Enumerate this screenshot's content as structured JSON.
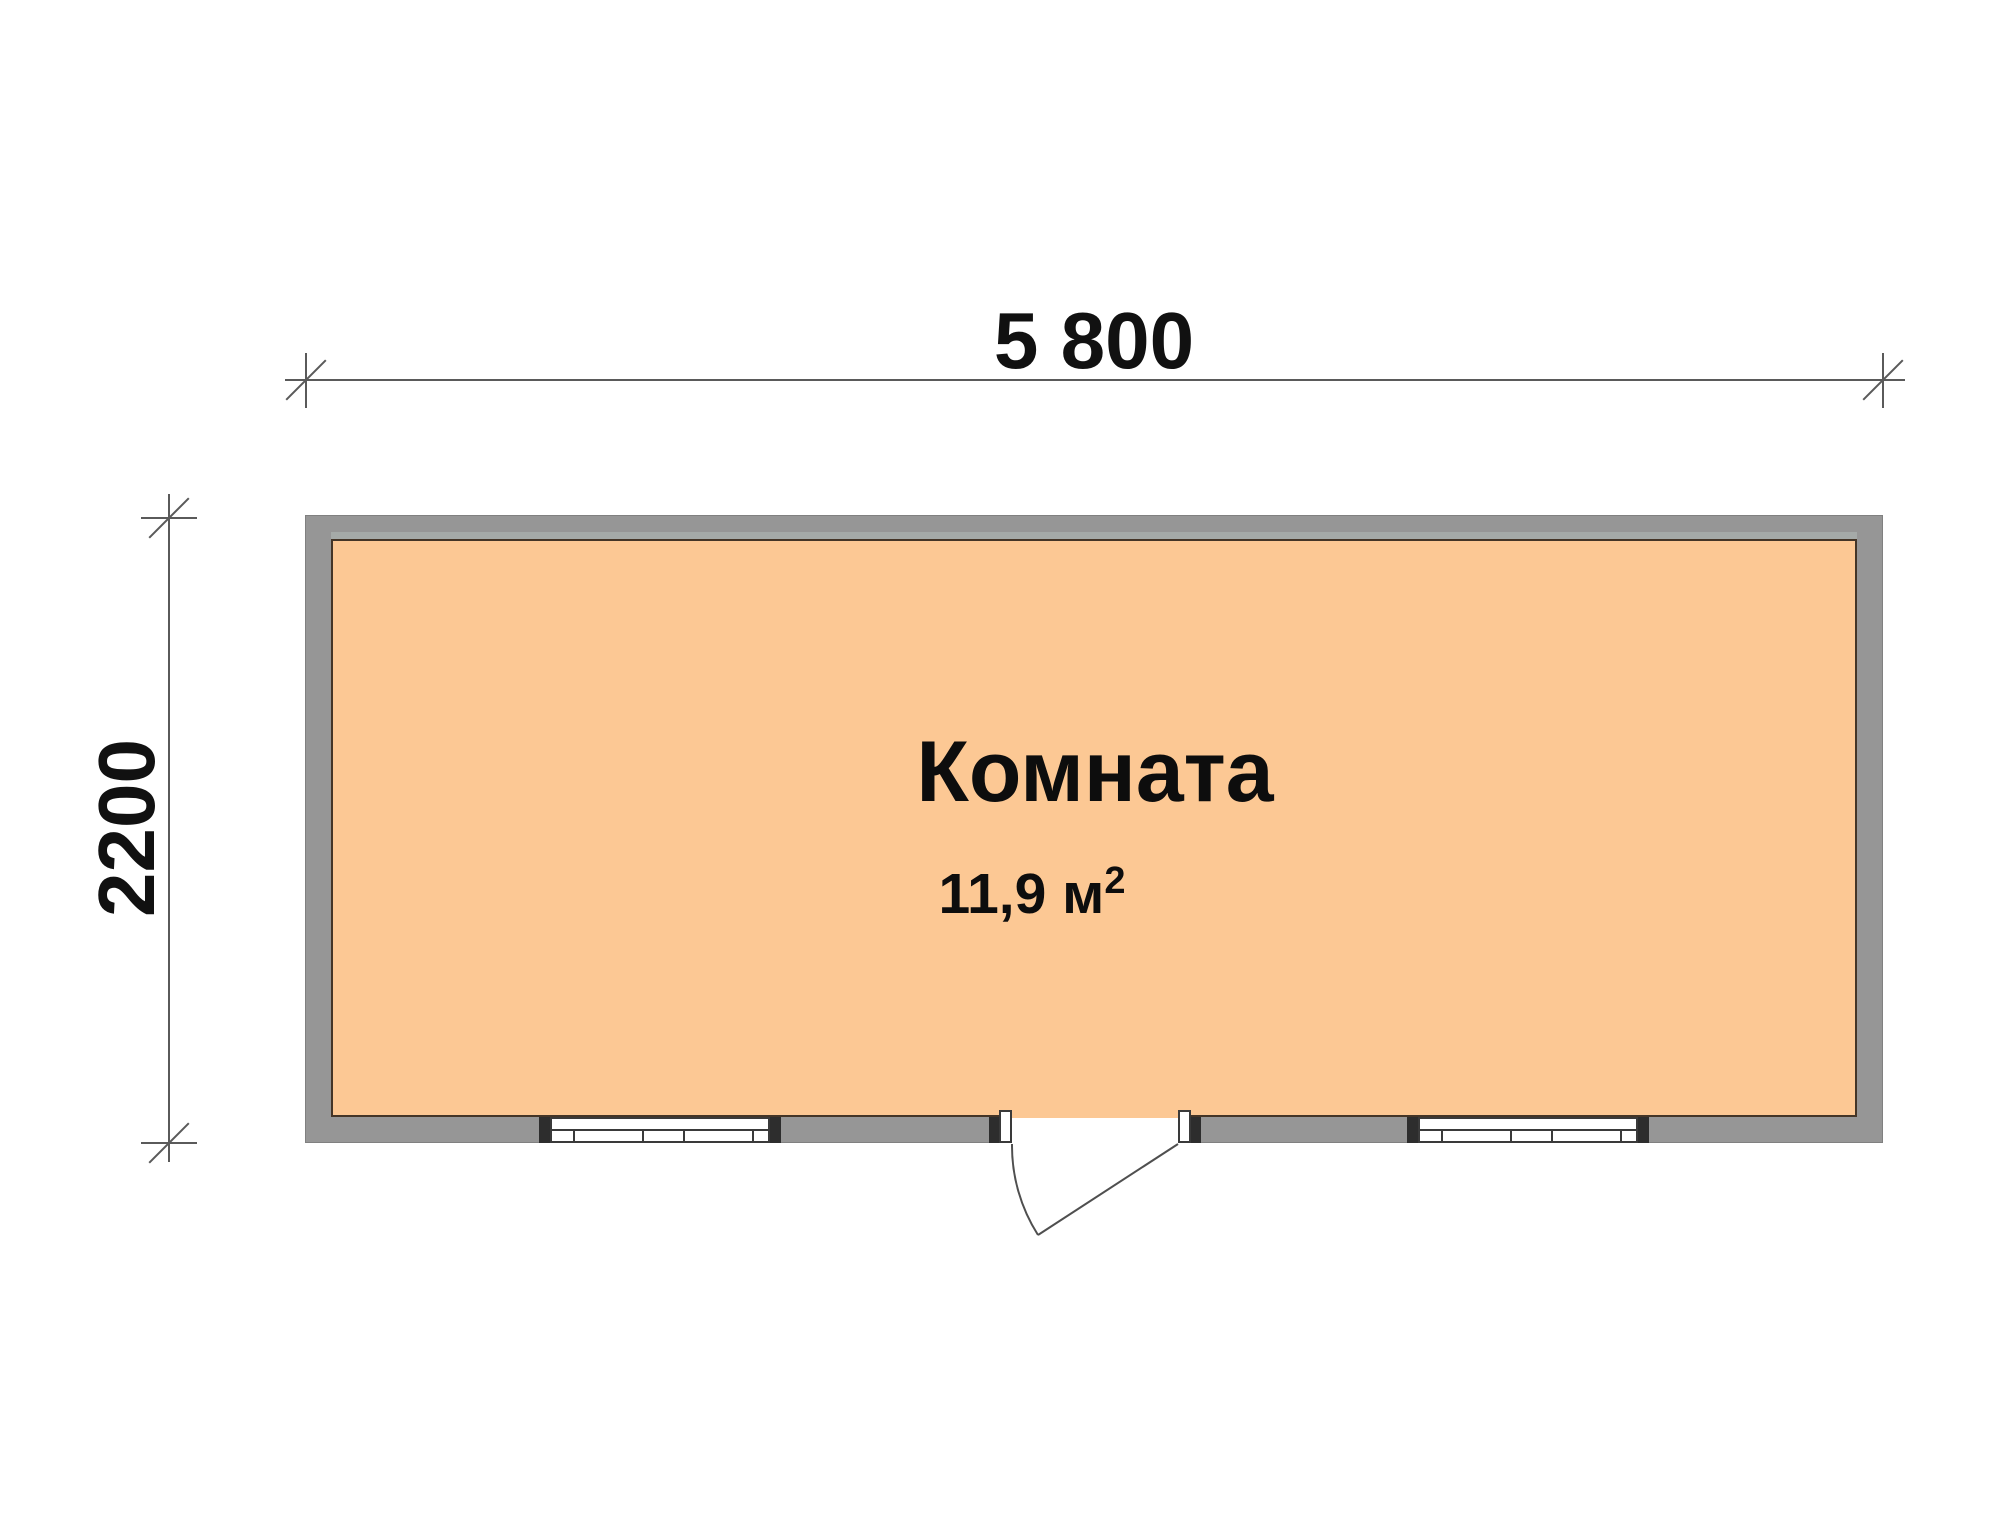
{
  "plan": {
    "dimensions": {
      "width": "5 800",
      "height": "2200"
    },
    "room": {
      "name": "Комната",
      "area_text": "11,9 м",
      "area_sup": "2"
    }
  },
  "colors": {
    "background": "#ffffff",
    "floor": "#fcc894",
    "wall": "#969696",
    "wall_highlight": "#a5aaa8",
    "floor_border": "#443527",
    "dim_line": "#5a5a5a",
    "dim_text": "#111111",
    "window_frame": "#3a3a3a",
    "end_cap": "#2d2d2d",
    "door_line": "#4f4f4f"
  }
}
